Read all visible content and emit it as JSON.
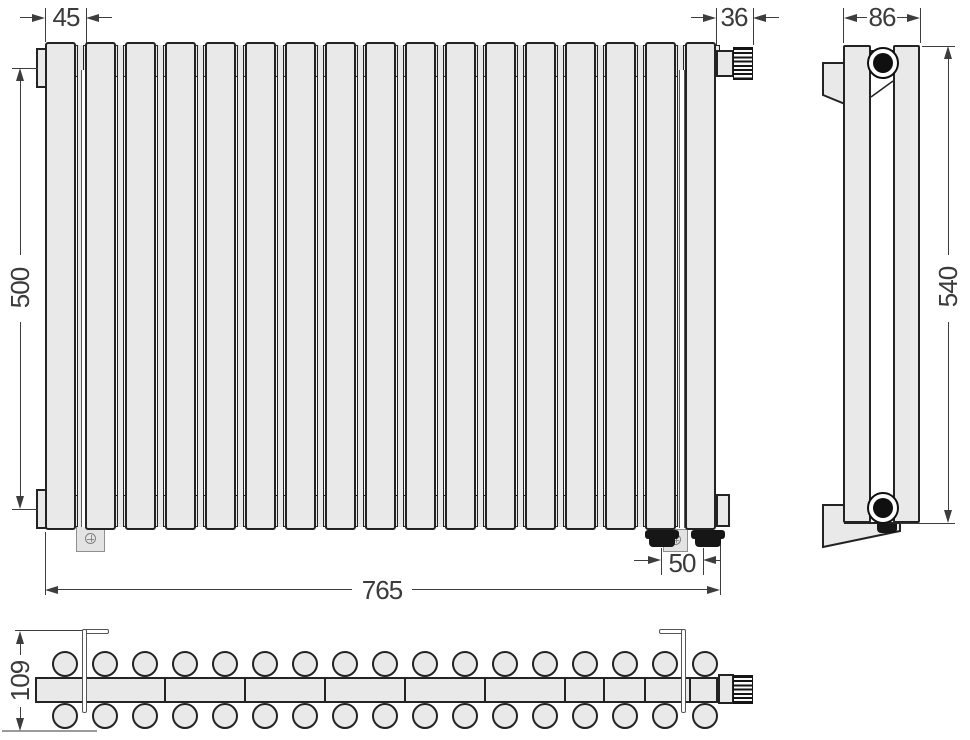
{
  "drawing": {
    "type": "radiator-three-view-technical-drawing",
    "sections": 17,
    "dims": {
      "section_pitch_mm": "45",
      "valve_width_mm": "36",
      "connection_height_mm": "500",
      "length_mm": "765",
      "outlet_spacing_mm": "50",
      "depth_mm": "86",
      "overall_height_mm": "540",
      "mounting_depth_mm": "109"
    },
    "colors": {
      "line": "#232323",
      "fill": "#e9e9e9",
      "dimension": "#3d3d3d",
      "bracket": "#555555"
    }
  }
}
